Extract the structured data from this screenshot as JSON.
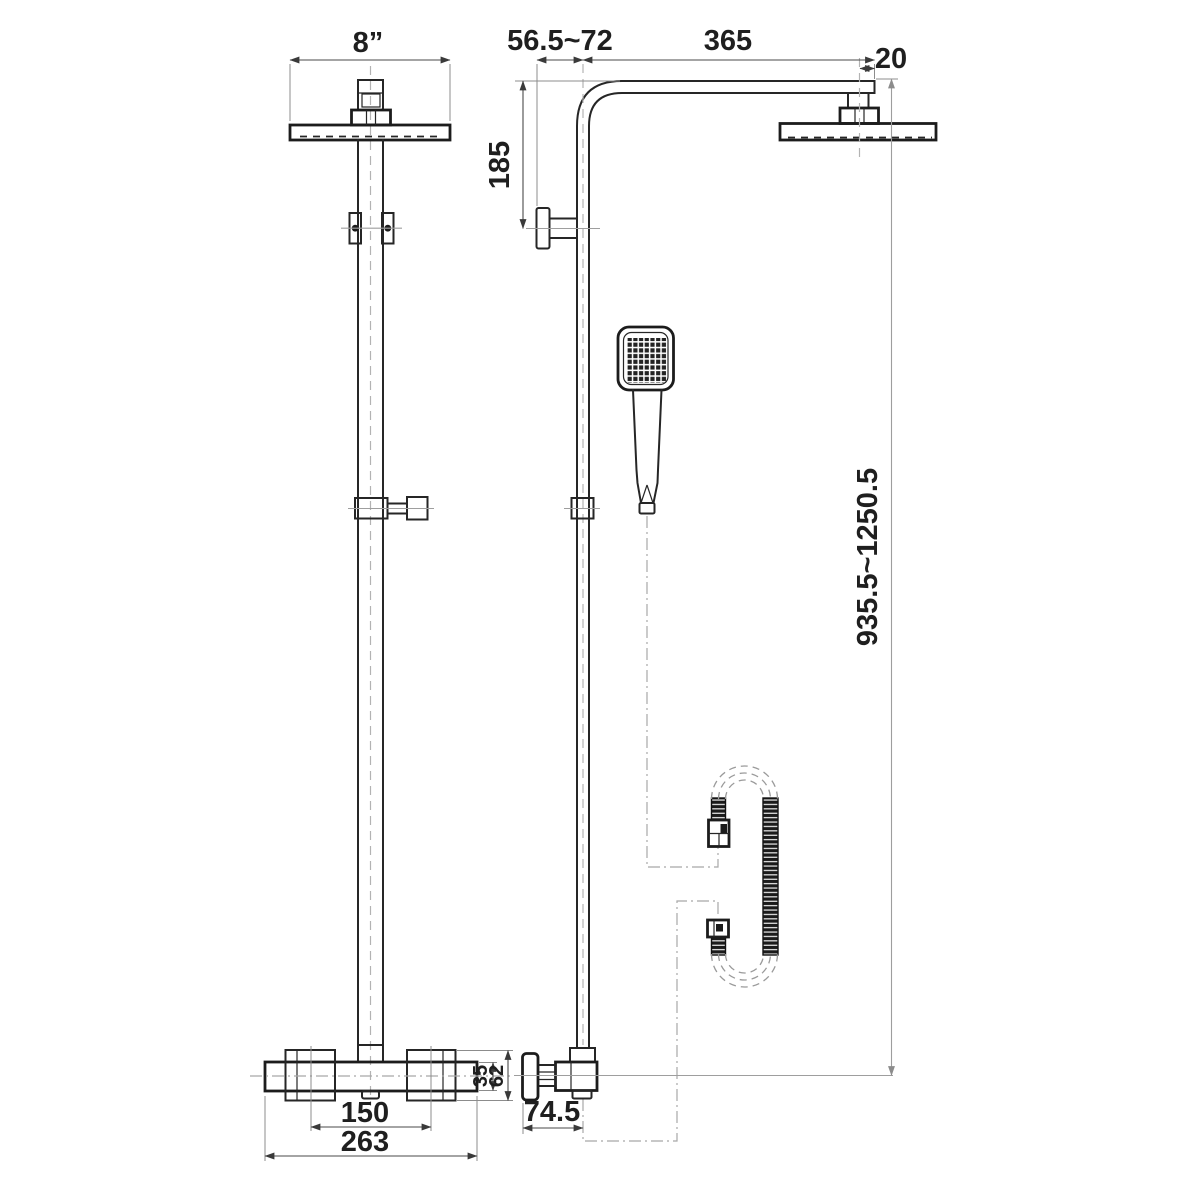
{
  "drawing": {
    "kind": "technical dimension drawing",
    "views": [
      "front elevation",
      "side elevation"
    ]
  },
  "dimensions": {
    "overhead_width": "8”",
    "wall_offset": "56.5~72",
    "arm_length": "365",
    "head_offset": "20",
    "arm_drop": "185",
    "riser_height": "935.5~1250.5",
    "valve_body_height": "35",
    "valve_overall_height": "62",
    "handle_centres": "150",
    "valve_width": "263",
    "valve_depth": "74.5"
  },
  "colors": {
    "background": "#ffffff",
    "part_line": "#262626",
    "dimension_line": "#4a4a4a",
    "centerline": "#b3b3b3",
    "leader_line": "#a8a8a8",
    "text": "#1f1f1f"
  }
}
